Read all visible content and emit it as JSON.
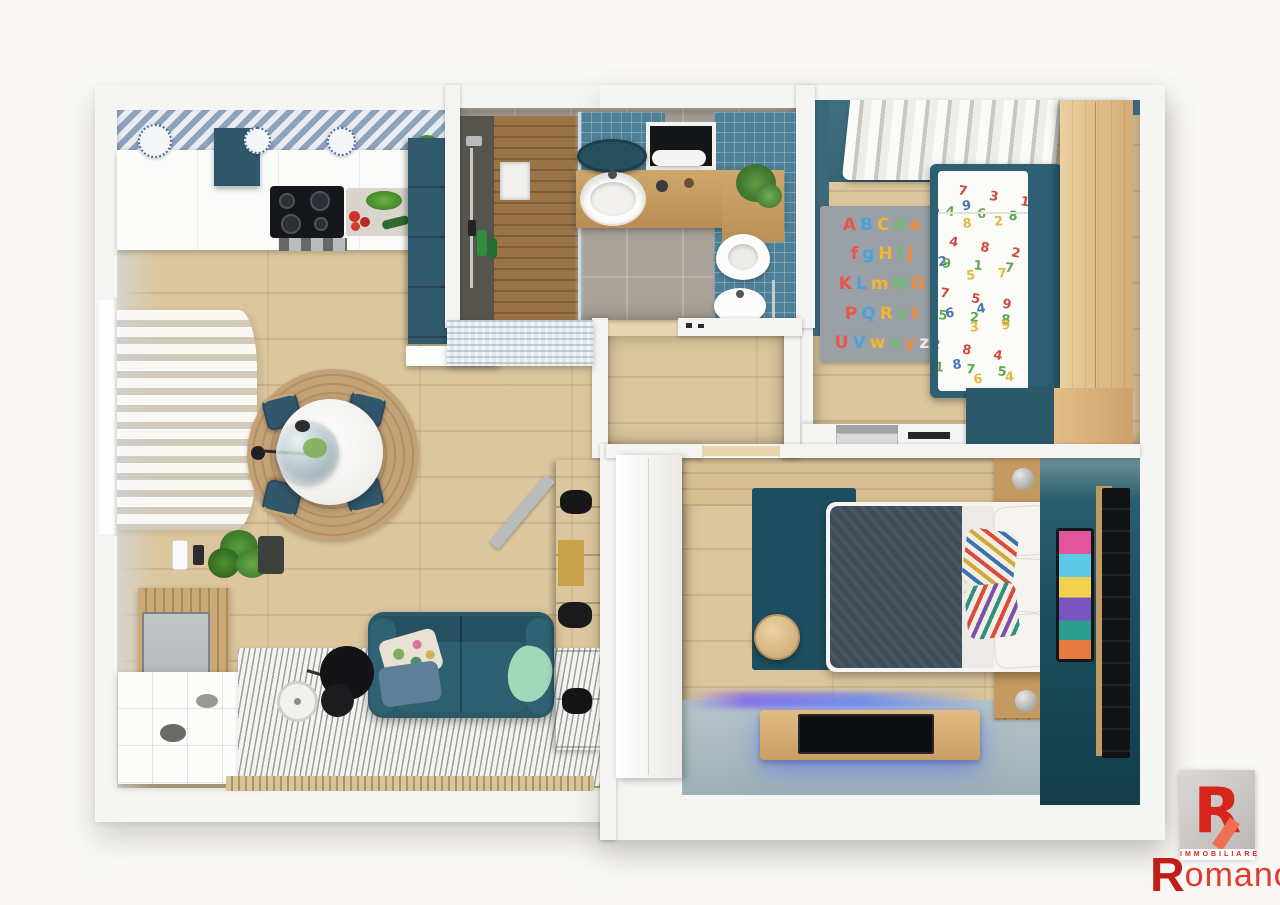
{
  "branding": {
    "tagline": "IMMOBILIARE",
    "name_initial": "R",
    "name_rest": "omano",
    "mark_letter": "R",
    "brand_red": "#d5251d",
    "brand_dark_red": "#bf1f17",
    "mark_background_gray": "#c5c2bf"
  },
  "kids_room": {
    "rug_rows": [
      "ABCde",
      "fgHIJ",
      "KLmNO",
      "PQRst",
      "UVwxyz"
    ],
    "bedding_numbers": {
      "red": "7 3 1\n4 8 2\n7 5 9\n2 8 4",
      "blue": "5 9 2\n6 4 8\n3 5 1\n9 6 3",
      "green": "4 6 8\n9 1 7\n5 2 8\n1 7 5",
      "yellow": "8 2\n5 7\n3 9\n6 4"
    }
  },
  "palette": {
    "background": "#f9f8f6",
    "wall_white": "#f5f5f3",
    "wood_floor": "#dbc69d",
    "wood_furniture": "#cda667",
    "teal_furniture": "#2a5a68",
    "teal_wall_kids": "#3c6879",
    "teal_wall_master": "#1c4f5d",
    "teal_rug_master": "#1d4e61",
    "duvet_gray_blue": "#3e4e59",
    "floor_gray_blue": "#a9bcc2",
    "tile_blue": "#4e8197",
    "tile_gray_floor": "#a9a298",
    "backsplash_blue": "#8ba3bb",
    "led_glow_blue": "#4f6cff",
    "mint_throw": "#a2d8ba",
    "jute_rug": "#c4a277"
  }
}
